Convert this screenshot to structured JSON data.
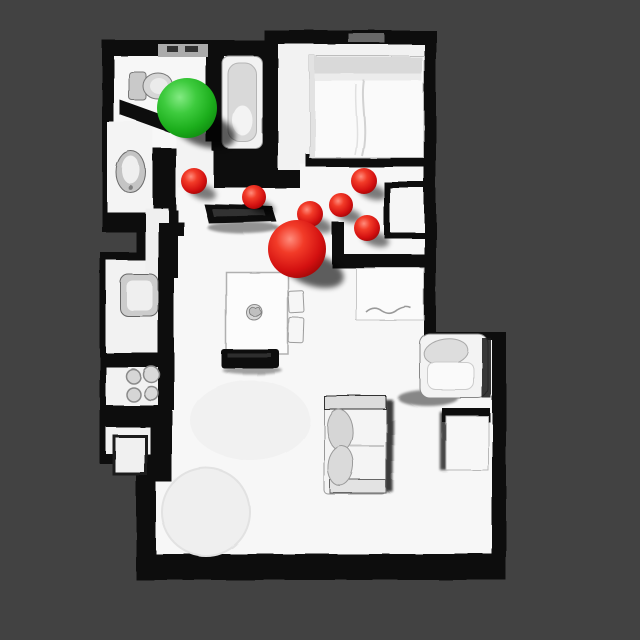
{
  "scene": {
    "background_color": "#424242",
    "wall_color": "#0b0b0b",
    "floor_color": "#f7f7f7",
    "markers": {
      "green_sphere": {
        "kind": "green",
        "x": 187,
        "y": 108,
        "r": 30,
        "color": "#2ec42e"
      },
      "red_sphere_large": {
        "kind": "red",
        "x": 297,
        "y": 249,
        "r": 29,
        "color": "#d41111"
      },
      "red_spheres_small": [
        {
          "kind": "red",
          "x": 194,
          "y": 181,
          "r": 13
        },
        {
          "kind": "red",
          "x": 254,
          "y": 197,
          "r": 12
        },
        {
          "kind": "red",
          "x": 310,
          "y": 214,
          "r": 13
        },
        {
          "kind": "red",
          "x": 341,
          "y": 205,
          "r": 12
        },
        {
          "kind": "red",
          "x": 364,
          "y": 181,
          "r": 13
        },
        {
          "kind": "red",
          "x": 367,
          "y": 228,
          "r": 13
        }
      ]
    }
  }
}
